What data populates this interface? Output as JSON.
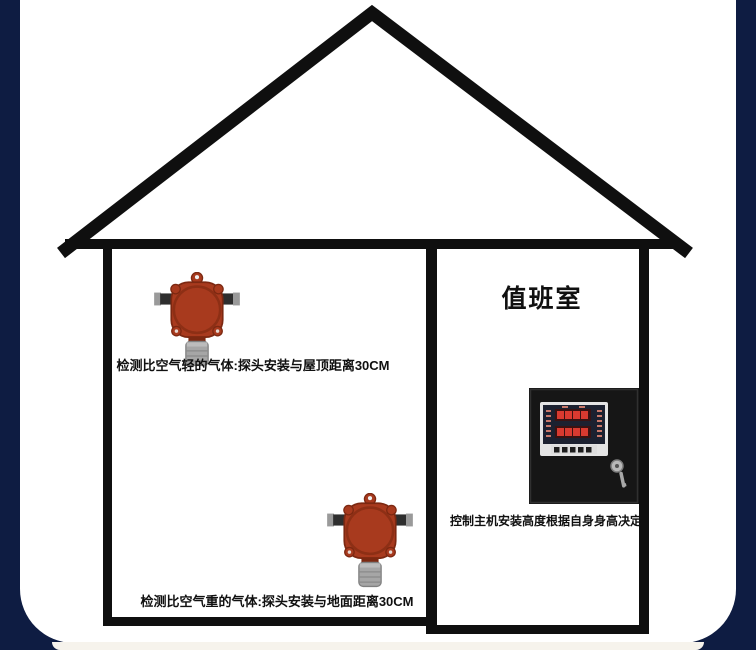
{
  "diagram": {
    "title_room": "值班室",
    "caption_light_gas": "检测比空气轻的气体:探头安装与屋顶距离30CM",
    "caption_heavy_gas": "检测比空气重的气体:探头安装与地面距离30CM",
    "caption_controller": "控制主机安装高度根据自身身高决定"
  },
  "colors": {
    "frame_navy": "#0e1c42",
    "bottom_strip": "#f6f3ec",
    "house_line": "#0f0f0f",
    "detector_body": "#a83a1e",
    "detector_outline": "#7c2811",
    "sensor_gray": "#a6a6a6",
    "conduit_dark": "#2e2e2e",
    "conduit_cap": "#9a9a9a",
    "panel_black": "#161616",
    "bezel_gray": "#e4e4e4",
    "display_dark": "#1c2130",
    "led_red": "#d93a30"
  }
}
